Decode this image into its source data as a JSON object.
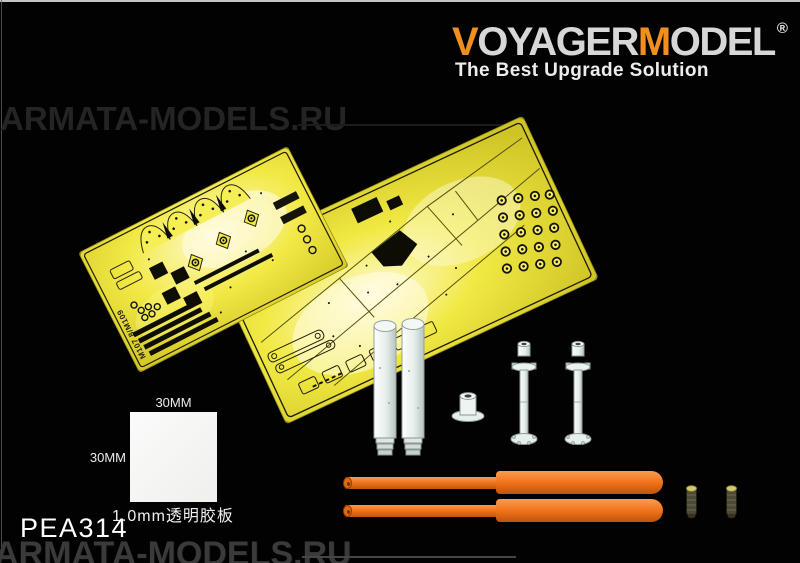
{
  "branding": {
    "logo": {
      "part_v": "V",
      "part_oyager": "OYAGER",
      "part_m": "M",
      "part_odel": "ODEL",
      "registered": "®"
    },
    "tagline": "The Best Upgrade Solution",
    "colors": {
      "accent_orange": "#ef8f1f",
      "letter_gray": "#d7d7d7",
      "tagline_white": "#ededed"
    }
  },
  "product": {
    "code": "PEA314"
  },
  "frets": {
    "small_fret_etched_label": "M107 8/M109",
    "color_yellow": "#f0e843"
  },
  "template_square": {
    "width_label": "30MM",
    "height_label": "30MM",
    "note": "1.0mm透明胶板"
  },
  "watermark": {
    "text_mid": "ARMATA-MODELS.RU",
    "text_bottom": "ARMATA-MODELS.RU"
  },
  "parts_colors": {
    "resin_white": "#edf3f1",
    "rod_orange": "#f2731c",
    "brass_olive": "#4c4936"
  }
}
